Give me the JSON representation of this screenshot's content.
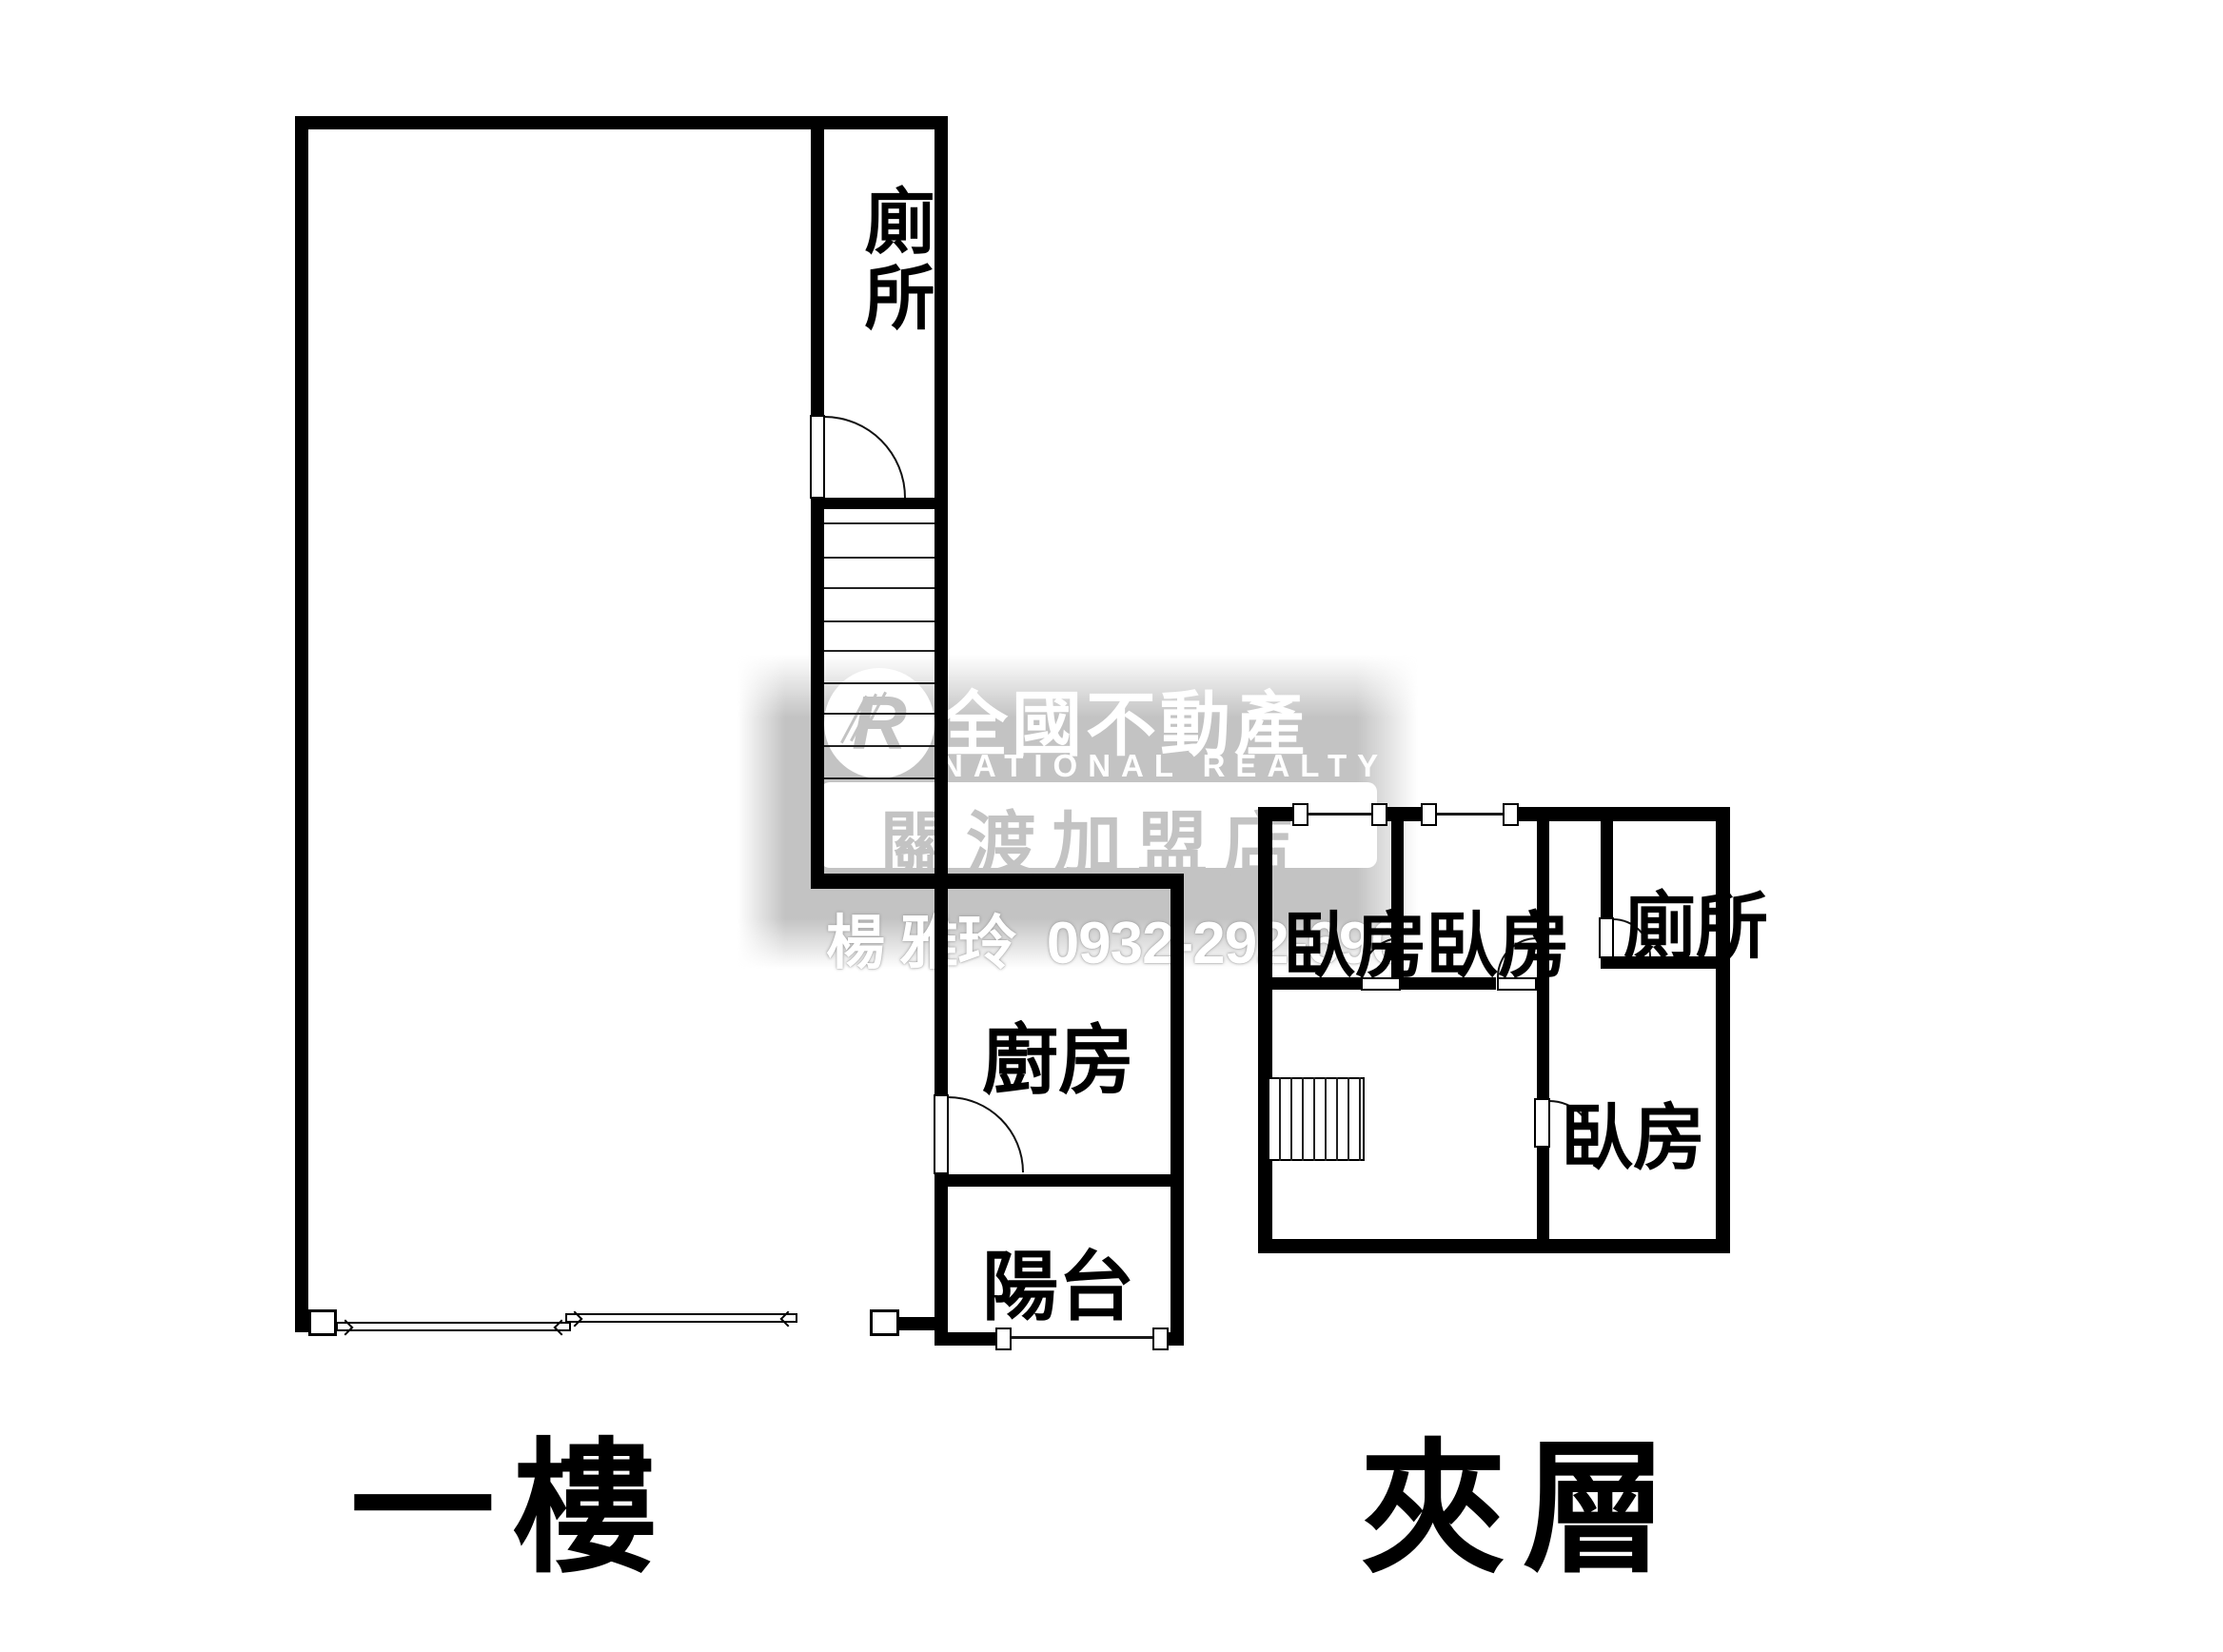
{
  "watermark": {
    "logo_letter": "R",
    "brand": "全國不動產",
    "brand_en": "NATIONAL REALTY",
    "branch": "關渡加盟店",
    "agent": "楊 雅玲",
    "phone": "0932-292-690",
    "gray_color": "#c3c3c3"
  },
  "floor1": {
    "caption": "一樓",
    "rooms": {
      "toilet": "廁所",
      "kitchen": "廚房",
      "balcony": "陽台"
    }
  },
  "mezzanine": {
    "caption": "夾層",
    "rooms": {
      "bedroom1": "臥房",
      "bedroom2": "臥房",
      "bedroom3": "臥房",
      "toilet": "廁所"
    }
  }
}
